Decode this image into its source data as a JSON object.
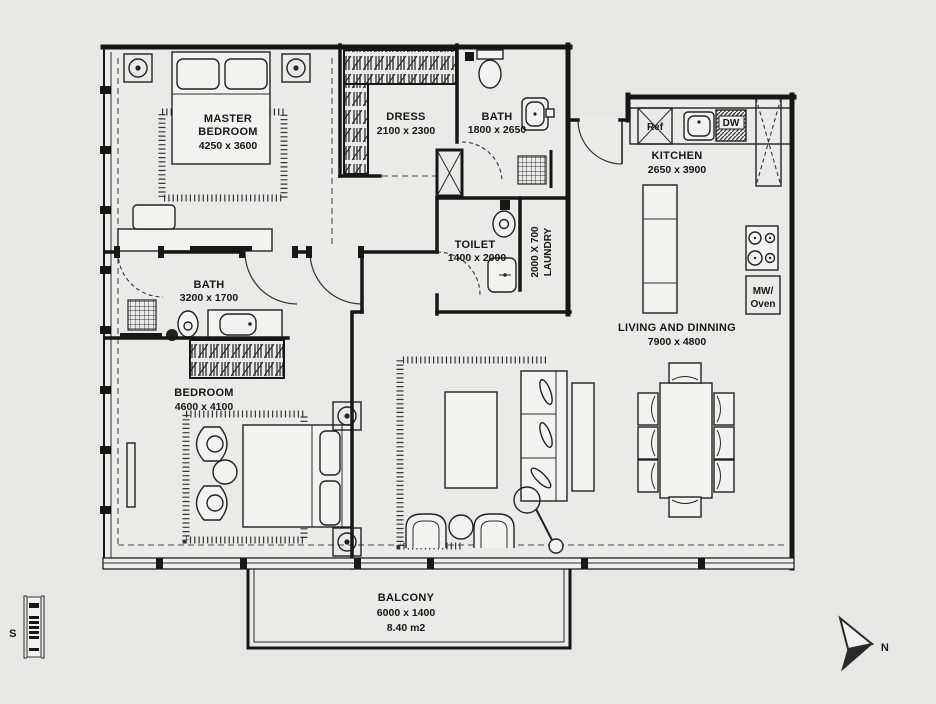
{
  "colors": {
    "background": "#e8e7e4",
    "line": "#171717",
    "furniture_fill": "#f3f2ef"
  },
  "rooms": {
    "master": {
      "line1": "MASTER",
      "line2": "BEDROOM",
      "dims": "4250 x 3600"
    },
    "dress": {
      "name": "DRESS",
      "dims": "2100 x 2300"
    },
    "bath_master": {
      "name": "BATH",
      "dims": "1800 x 2650"
    },
    "kitchen": {
      "name": "KITCHEN",
      "dims": "2650 x 3900"
    },
    "toilet": {
      "name": "TOILET",
      "dims": "1400 x 2000"
    },
    "laundry": {
      "name": "LAUNDRY",
      "dims": "2000 X 700"
    },
    "bath2": {
      "name": "BATH",
      "dims": "3200 x 1700"
    },
    "bedroom": {
      "name": "BEDROOM",
      "dims": "4600 x 4100"
    },
    "living": {
      "name": "LIVING AND DINNING",
      "dims": "7900 x 4800"
    },
    "balcony": {
      "name": "BALCONY",
      "dims": "6000 x 1400",
      "area": "8.40 m2"
    }
  },
  "appliances": {
    "ref": "Ref",
    "dw": "DW",
    "mw_line1": "MW/",
    "mw_line2": "Oven"
  },
  "compass": {
    "north": "N",
    "section": "S"
  }
}
